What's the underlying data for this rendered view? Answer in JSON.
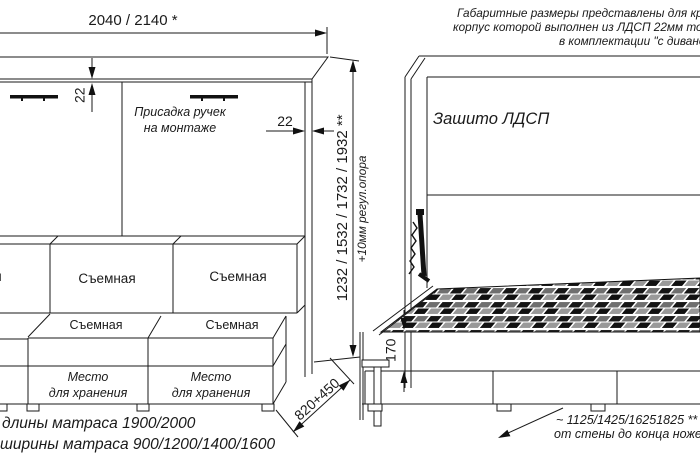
{
  "note": {
    "line1": "Габаритные размеры представлены для кров",
    "line2": "корпус которой выполнен из ЛДСП 22мм толщи",
    "line3": "в комплектации \"с диваном\""
  },
  "closed_view": {
    "width_dim": "2040 / 2140 *",
    "top_panel_thickness": "22",
    "side_panel_thickness": "22",
    "handles_note": {
      "line1": "Присадка ручек",
      "line2": "на монтаже"
    },
    "height_dim": "1232 / 1532 / 1732 / 1932 **",
    "height_note": "+10мм регул.опора",
    "depth_dim": "820+450",
    "back_cushions": [
      "Съемная",
      "Съемная",
      "Съемная"
    ],
    "seat_cushions": [
      "Съемная",
      "Съемная"
    ],
    "storage": {
      "line1": "Место",
      "line2": "для хранения"
    }
  },
  "open_view": {
    "panel_label": "Зашито ЛДСП",
    "base_height_dim": "170",
    "floor_note": {
      "line1": "~ 1125/1425/16251825 **",
      "line2": "от стены до конца ножек"
    }
  },
  "footnotes": {
    "line1": "длины матраса 1900/2000",
    "line2": "ширины матраса 900/1200/1400/1600"
  },
  "colors": {
    "line": "#1a1a1a",
    "background": "#ffffff",
    "slat_dark": "#111111",
    "slat_gray": "#999999"
  }
}
